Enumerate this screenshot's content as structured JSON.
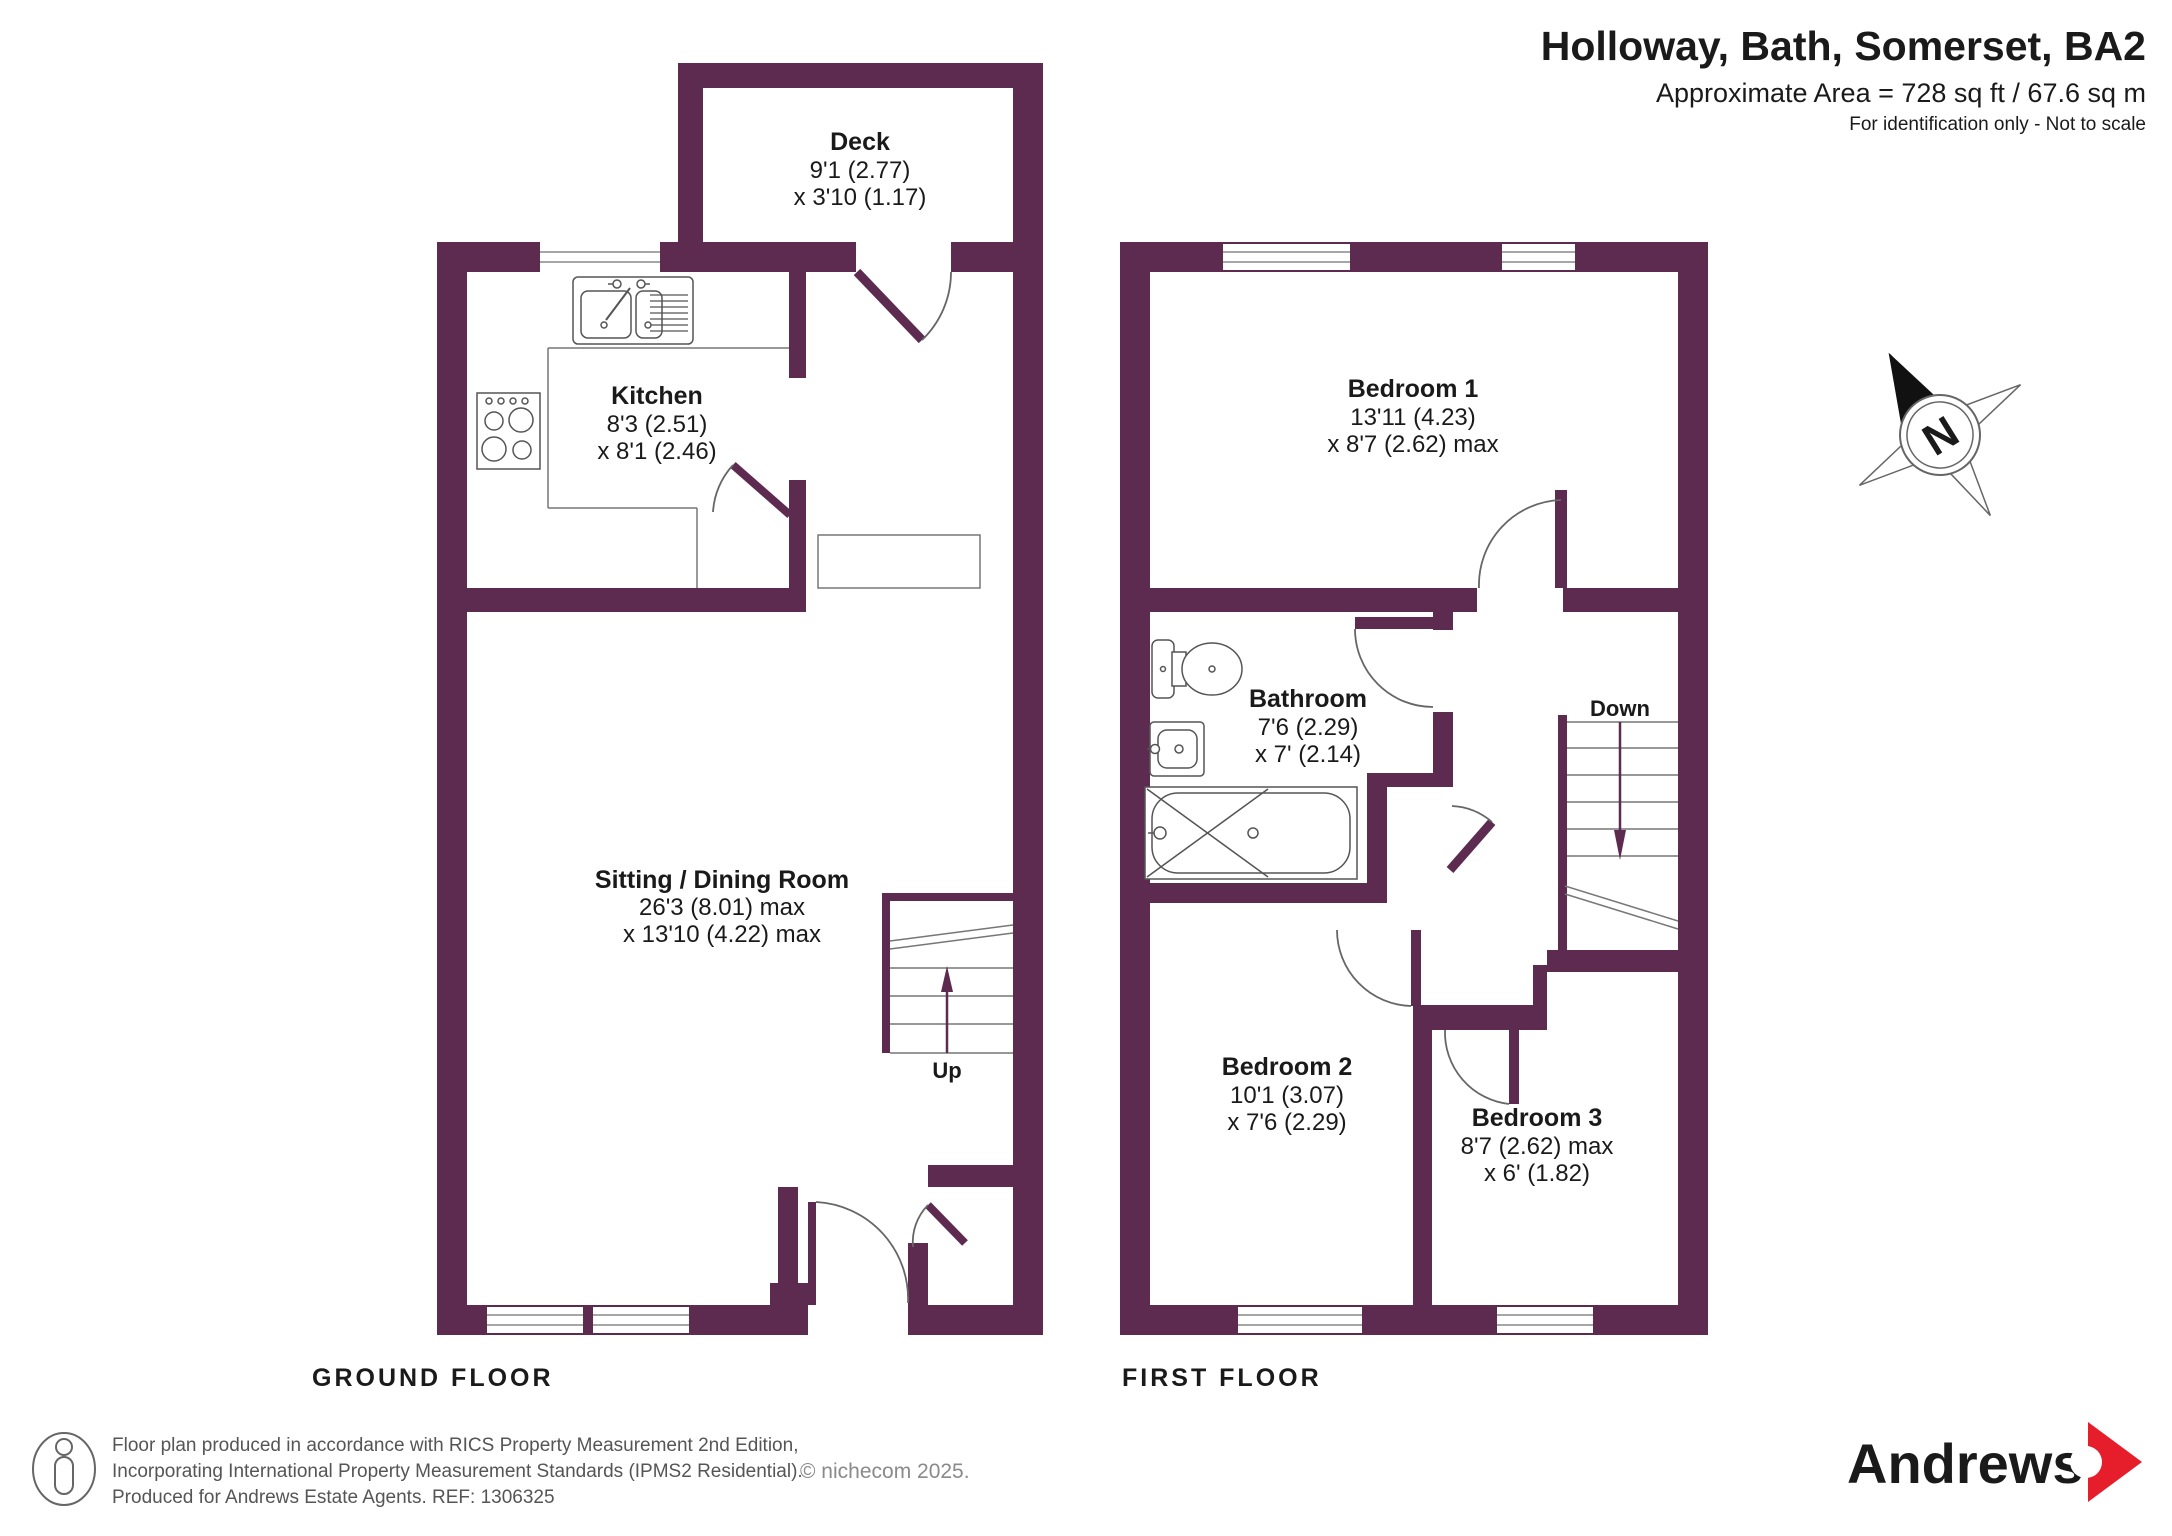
{
  "header": {
    "title": "Holloway, Bath, Somerset, BA2",
    "area_line": "Approximate Area = 728 sq ft / 67.6 sq m",
    "note_line": "For identification only - Not to scale"
  },
  "ground_floor": {
    "label": "GROUND FLOOR",
    "stairs_label": "Up",
    "rooms": [
      {
        "name": "Deck",
        "dims": [
          "9'1 (2.77)",
          "x 3'10 (1.17)"
        ]
      },
      {
        "name": "Kitchen",
        "dims": [
          "8'3 (2.51)",
          "x 8'1 (2.46)"
        ]
      },
      {
        "name": "Sitting / Dining Room",
        "dims": [
          "26'3 (8.01) max",
          "x 13'10 (4.22) max"
        ]
      }
    ]
  },
  "first_floor": {
    "label": "FIRST FLOOR",
    "stairs_label": "Down",
    "rooms": [
      {
        "name": "Bedroom 1",
        "dims": [
          "13'11 (4.23)",
          "x 8'7 (2.62) max"
        ]
      },
      {
        "name": "Bathroom",
        "dims": [
          "7'6 (2.29)",
          "x 7' (2.14)"
        ]
      },
      {
        "name": "Bedroom 2",
        "dims": [
          "10'1 (3.07)",
          "x 7'6 (2.29)"
        ]
      },
      {
        "name": "Bedroom 3",
        "dims": [
          "8'7 (2.62) max",
          "x 6' (1.82)"
        ]
      }
    ]
  },
  "compass": {
    "label": "N"
  },
  "footer": {
    "line1": "Floor plan produced in accordance with RICS Property Measurement 2nd Edition,",
    "line2": "Incorporating International Property Measurement Standards (IPMS2 Residential).",
    "line3": "Produced for Andrews Estate Agents.   REF: 1306325",
    "copyright": "© nichecom 2025.",
    "brand": "Andrews"
  },
  "colors": {
    "wall": "#5e2b50",
    "brand_plum": "#572144",
    "accent_red": "#e61e2b",
    "fixture_line": "#555555",
    "glazing_line": "#888888"
  }
}
